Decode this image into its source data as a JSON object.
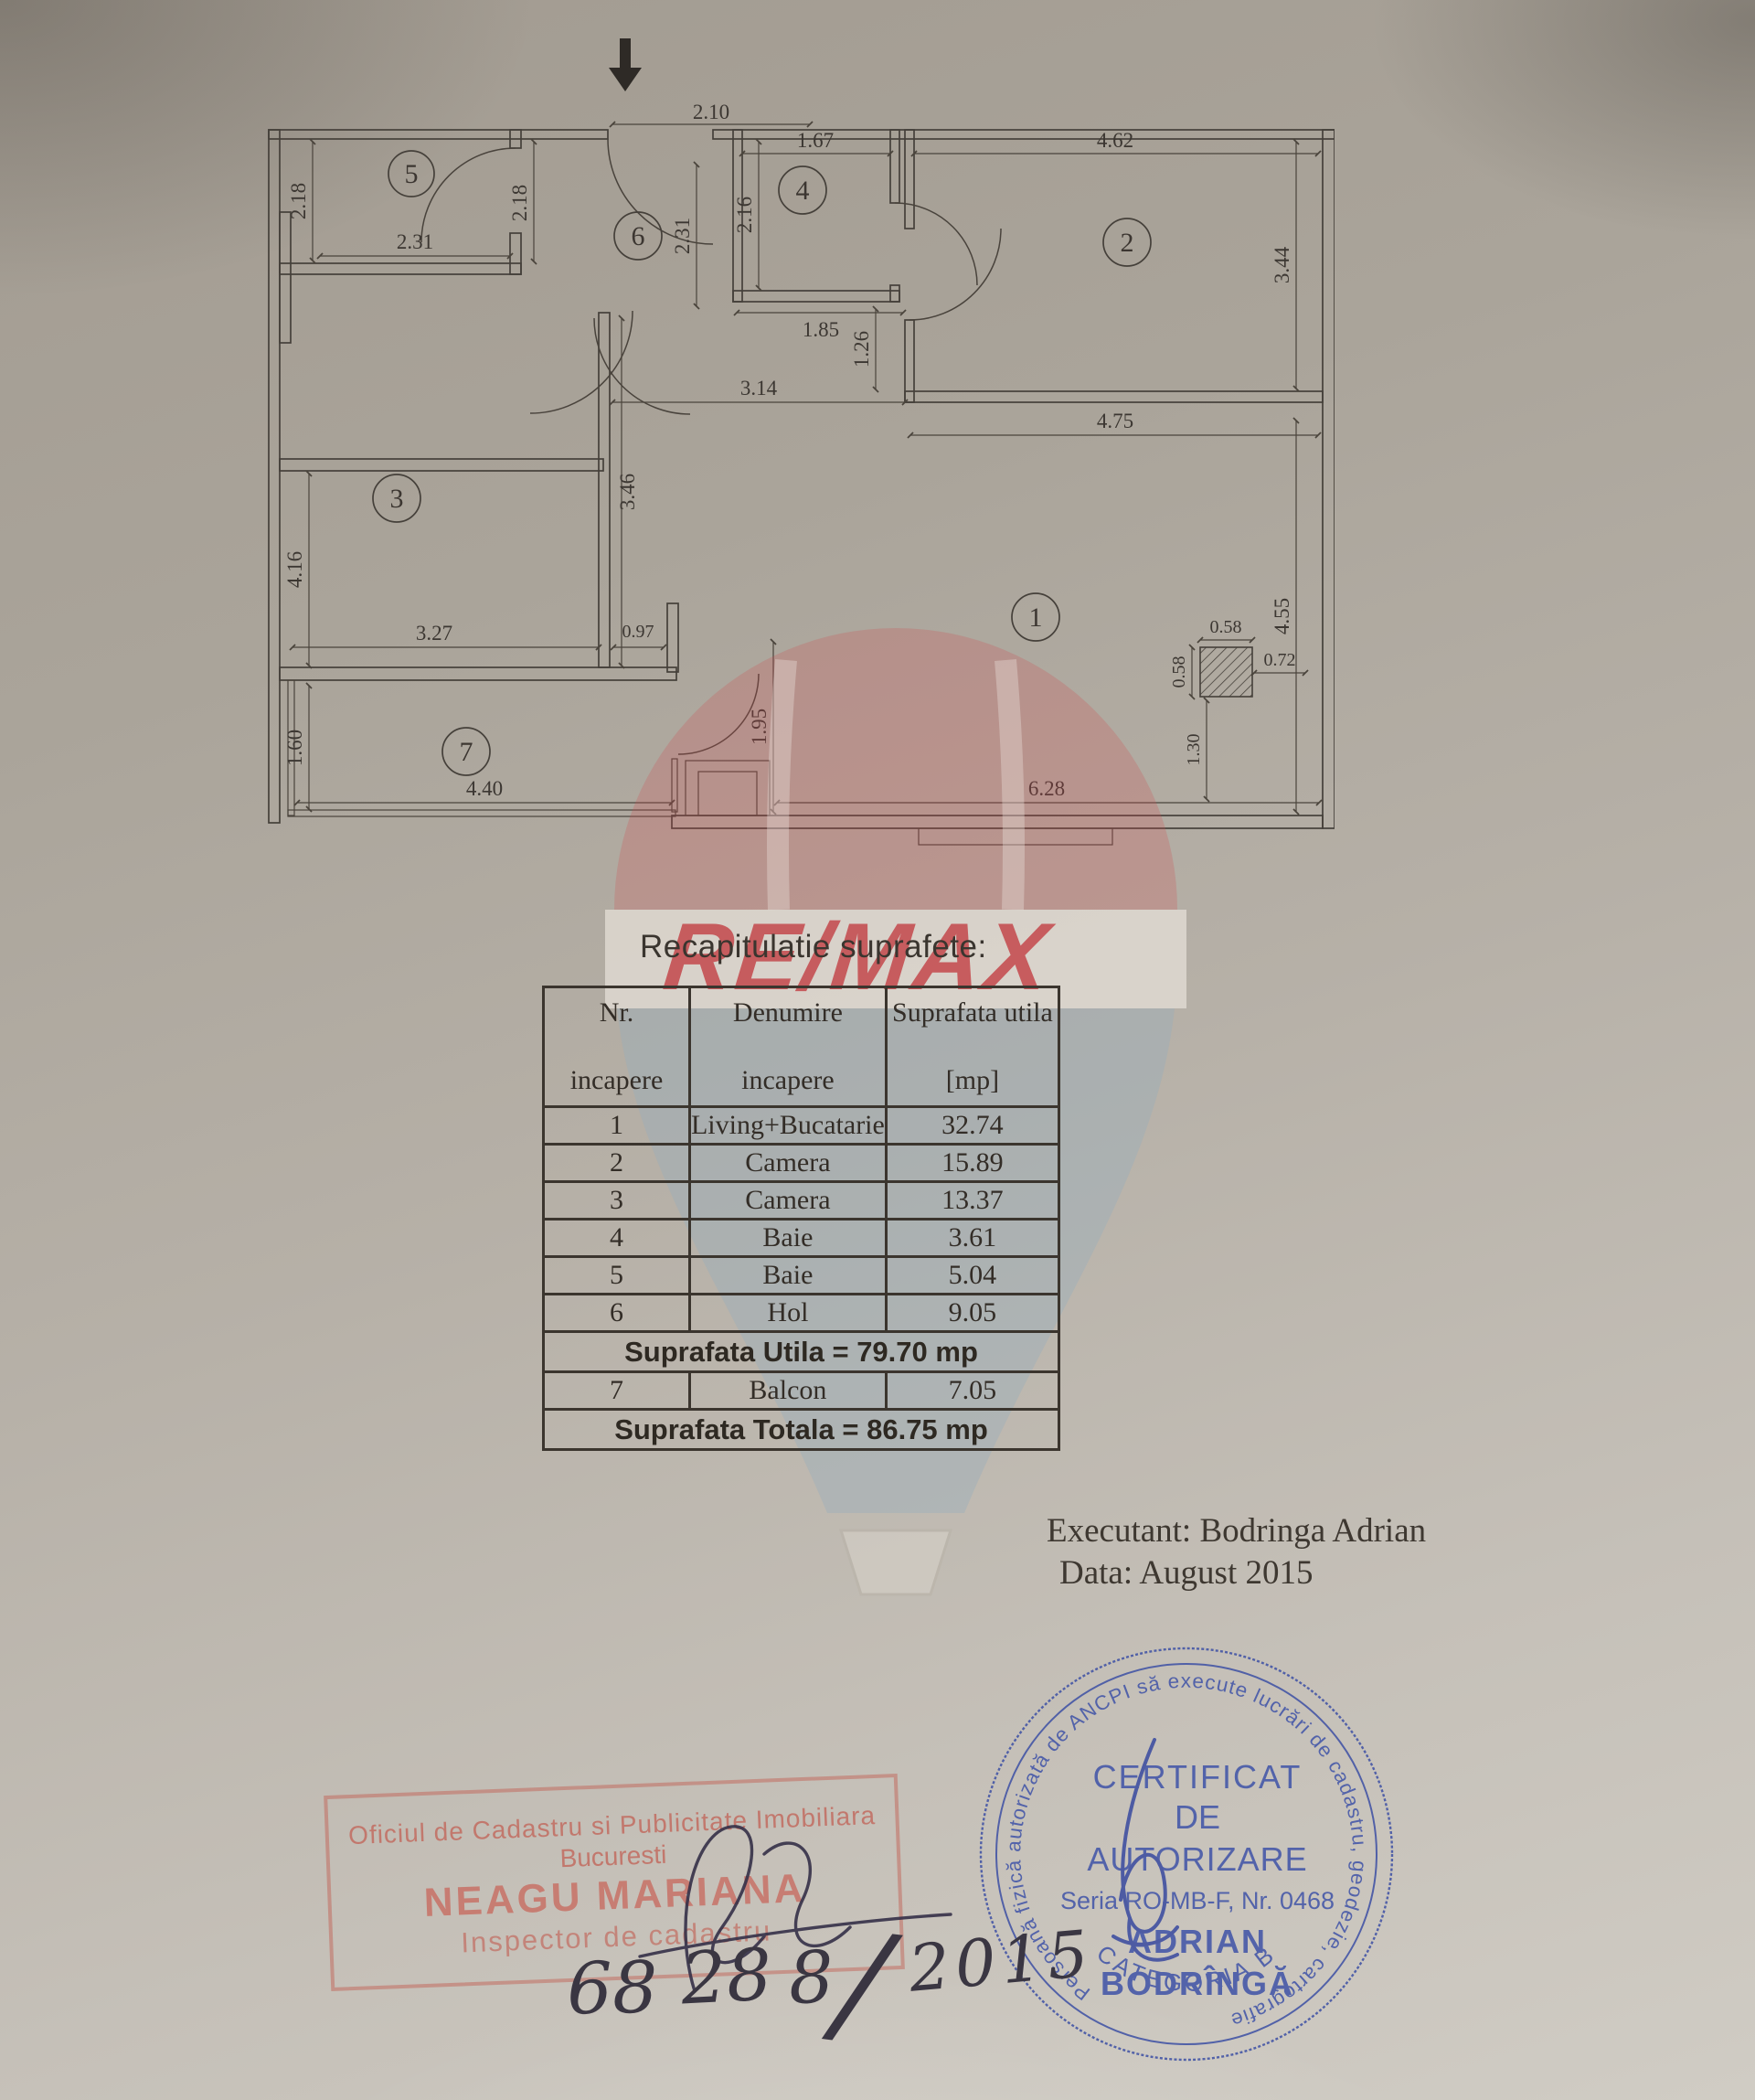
{
  "page": {
    "heading": "Recapitulatie suprafete:"
  },
  "plan": {
    "rooms": {
      "r1": "1",
      "r2": "2",
      "r3": "3",
      "r4": "4",
      "r5": "5",
      "r6": "6",
      "r7": "7"
    },
    "dims": {
      "entrance_width": "2.10",
      "bath4_width": "1.67",
      "room2_width": "4.62",
      "bath5_height": "2.18",
      "bath5_width": "2.31",
      "bath5_wall": "2.18",
      "hall_height": "2.31",
      "bath4_height": "2.16",
      "room2_height": "3.44",
      "bath4_bottom": "1.85",
      "vestibule_height": "1.26",
      "living_top": "4.75",
      "living_upper_left": "3.14",
      "room3_height": "4.16",
      "room3_wall": "3.46",
      "room3_width": "3.27",
      "passage_width": "0.97",
      "balcony_height": "1.60",
      "balcony_width": "4.40",
      "balcony_nook": "1.95",
      "living_bottom": "6.28",
      "living_right": "4.55",
      "column_top": "0.58",
      "column_left": "0.58",
      "column_right": "0.72",
      "column_below": "1.30"
    }
  },
  "watermark": {
    "brand": "RE/MAX"
  },
  "table": {
    "headers": {
      "col1a": "Nr.",
      "col1b": "incapere",
      "col2a": "Denumire",
      "col2b": "incapere",
      "col3a": "Suprafata utila",
      "col3b": "[mp]"
    },
    "rows": [
      {
        "nr": "1",
        "name": "Living+Bucatarie",
        "area": "32.74"
      },
      {
        "nr": "2",
        "name": "Camera",
        "area": "15.89"
      },
      {
        "nr": "3",
        "name": "Camera",
        "area": "13.37"
      },
      {
        "nr": "4",
        "name": "Baie",
        "area": "3.61"
      },
      {
        "nr": "5",
        "name": "Baie",
        "area": "5.04"
      },
      {
        "nr": "6",
        "name": "Hol",
        "area": "9.05"
      }
    ],
    "utila_band": "Suprafata Utila  =  79.70 mp",
    "balcon_row": {
      "nr": "7",
      "name": "Balcon",
      "area": "7.05"
    },
    "totala_band": "Suprafata Totala  =   86.75 mp"
  },
  "footer": {
    "executant": "Executant:  Bodringa  Adrian",
    "date": "Data: August 2015"
  },
  "stamps": {
    "office": {
      "line1": "Oficiul de Cadastru si Publicitate Imobiliara",
      "line2": "Bucuresti",
      "line3": "NEAGU MARIANA",
      "line4": "Inspector de cadastru"
    },
    "round": {
      "ring": "Persoană fizică autorizată de ANCPI să execute lucrări de cadastru, geodezie, cartografie",
      "category": "CATEGORIA B",
      "l1": "CERTIFICAT",
      "l2": "DE",
      "l3": "AUTORIZARE",
      "l4": "Seria RO-MB-F, Nr. 0468",
      "l5": "ADRIAN",
      "l6": "BODRÎNGĂ"
    }
  },
  "handwriting": {
    "part1": "68",
    "part2": "28",
    "part3": "8",
    "slash": "/",
    "year": "2015"
  }
}
